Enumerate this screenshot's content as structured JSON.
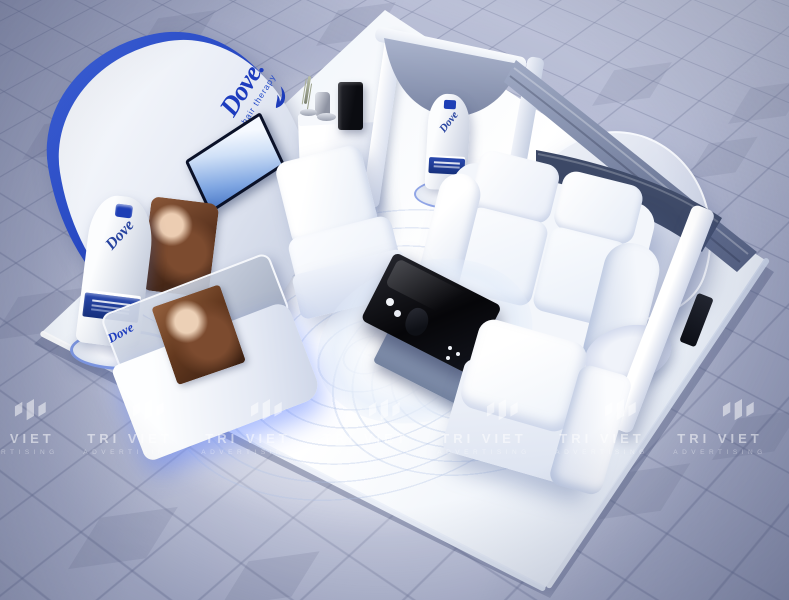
{
  "branding": {
    "logo_text": "Dove.",
    "tagline": "hair therapy",
    "bottle_brand": "Dove",
    "counter_brand": "Dove"
  },
  "watermark": {
    "name": "TRI VIET",
    "subtitle": "ADVERTISING"
  },
  "icons": [
    {
      "name": "dove-bird-icon",
      "meaning": "Dove brand bird silhouette"
    },
    {
      "name": "watermark-logo-icon",
      "meaning": "Tri Viet Advertising isometric logo mark"
    }
  ],
  "palette": {
    "dove_blue": "#1d3cbe",
    "floor_tile": "#b2b8d2",
    "platform_white": "#f4f7fc",
    "drape_slate": "#8d98b6",
    "canopy_navy": "#3c4866",
    "table_black": "#0a0b10"
  }
}
